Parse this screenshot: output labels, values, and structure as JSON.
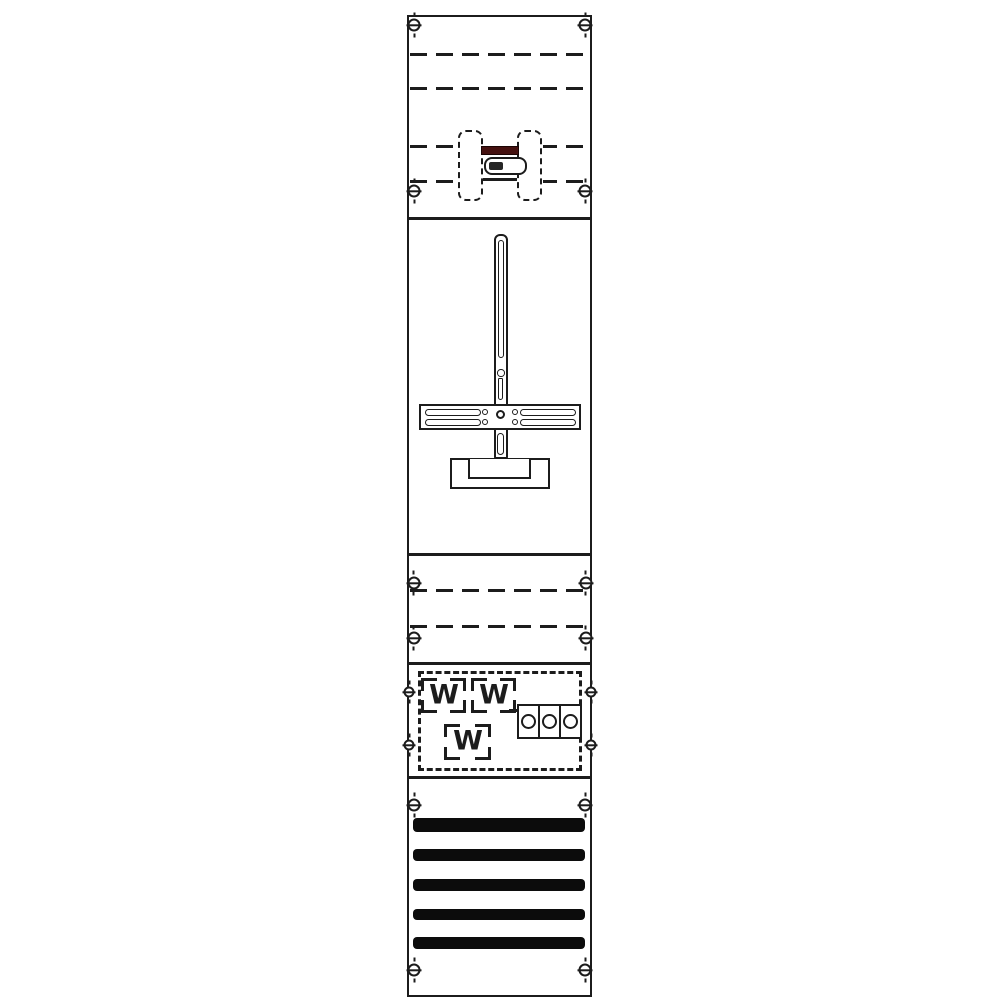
{
  "meta": {
    "type": "technical-line-diagram",
    "title": "Meter panel field diagram",
    "colors": {
      "line": "#1c1c1c",
      "accent": "#451110",
      "bar": "#0c0c0c",
      "bg": "#ffffff"
    }
  },
  "meters": {
    "labels": [
      "W",
      "W",
      "W"
    ]
  },
  "terminal_block": {
    "circle_count": 3
  },
  "busbar_field": {
    "bar_count": 5
  },
  "mounting_rails": {
    "top_dashed_lines": 4,
    "middle_dashed_lines": 2,
    "screw_count": 16
  }
}
